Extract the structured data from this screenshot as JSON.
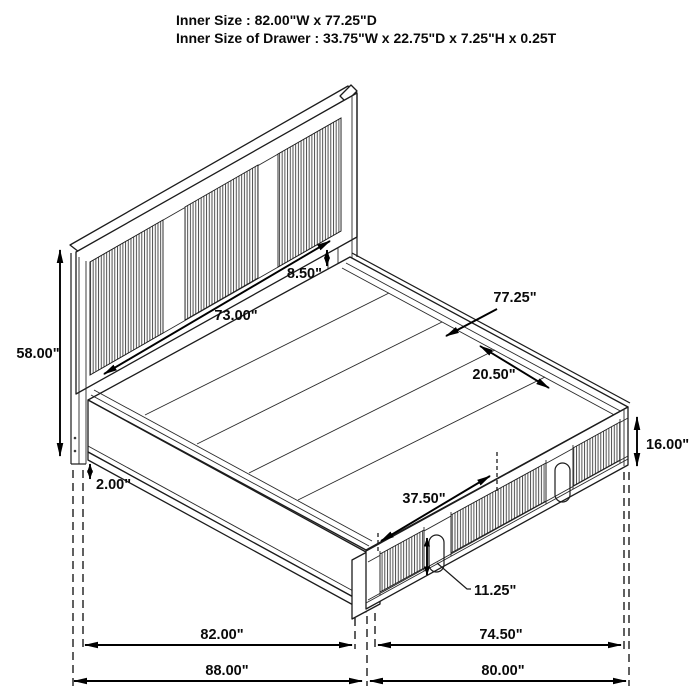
{
  "title": {
    "line1": "Inner Size : 82.00\"W x 77.25\"D",
    "line2": "Inner Size of Drawer : 33.75\"W x 22.75\"D x 7.25\"H x 0.25T"
  },
  "dims": {
    "headboard_height": "58.00\"",
    "floor_clearance": "2.00\"",
    "headboard_width": "73.00\"",
    "deck_gap": "8.50\"",
    "platform_depth": "77.25\"",
    "deck_panel_depth": "20.50\"",
    "footboard_height": "16.00\"",
    "drawer_front_width": "37.50\"",
    "drawer_handle_height": "11.25\"",
    "inner_width": "82.00\"",
    "footboard_width": "74.50\"",
    "overall_width": "88.00\"",
    "overall_depth": "80.00\""
  },
  "colors": {
    "line": "#1c1c1c",
    "dimension": "#000000",
    "background": "#ffffff",
    "slat": "#4a4a4a"
  }
}
